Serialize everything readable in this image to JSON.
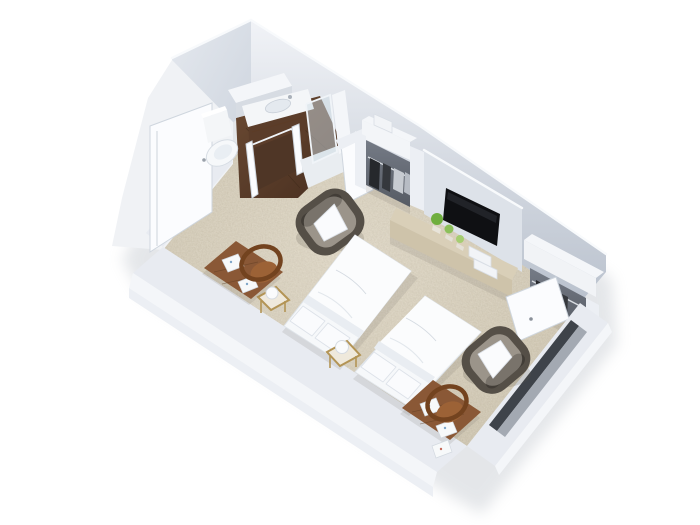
{
  "scene": {
    "type": "3d-floorplan-render",
    "description": "Isometric cutaway 3D rendering of a twin hotel guest room with en-suite bathroom",
    "background": "#ffffff",
    "rooms": [
      "bathroom",
      "entry-hall",
      "bedroom"
    ],
    "no_visible_text": true
  },
  "objects": [
    {
      "id": "toilet",
      "label": "toilet"
    },
    {
      "id": "vanity",
      "label": "vanity with sink"
    },
    {
      "id": "shower",
      "label": "glass shower"
    },
    {
      "id": "entry-door",
      "label": "open entry door"
    },
    {
      "id": "wardrobe-1",
      "label": "open wardrobe with hanging clothes"
    },
    {
      "id": "tv",
      "label": "wall-mounted flat screen tv"
    },
    {
      "id": "media-console",
      "label": "long media console with plants"
    },
    {
      "id": "plants",
      "label": "three small green plants"
    },
    {
      "id": "wardrobe-2",
      "label": "corner wardrobe with open door"
    },
    {
      "id": "bed-1",
      "label": "twin bed with white bedding"
    },
    {
      "id": "bed-2",
      "label": "twin bed with white bedding"
    },
    {
      "id": "nightstand-1",
      "label": "brass stand with sphere lamp"
    },
    {
      "id": "nightstand-2",
      "label": "brass stand with sphere lamp"
    },
    {
      "id": "desk-1",
      "label": "wooden desk with papers"
    },
    {
      "id": "desk-2",
      "label": "wooden desk with papers"
    },
    {
      "id": "chair-1",
      "label": "round-back wooden chair"
    },
    {
      "id": "chair-2",
      "label": "round-back wooden chair"
    },
    {
      "id": "armchair-1",
      "label": "taupe armchair with white cushion"
    },
    {
      "id": "armchair-2",
      "label": "taupe armchair with white cushion"
    },
    {
      "id": "window",
      "label": "dark window band in front wall"
    }
  ],
  "palette": {
    "carpet": "#d6cdb9",
    "carpet_light": "#e0d8c6",
    "carpet_dark": "#c7bda6",
    "wall_top": "#f1f3f7",
    "wall_light": "#e4e8ee",
    "wall_mid": "#ccd3dd",
    "wall_dark": "#b9c1cd",
    "wall_outer": "#f0f2f5",
    "wall_face": "#e8ebf1",
    "wood_light": "#6b4a33",
    "wood_dark": "#472e1f",
    "desk_wood": "#8a5836",
    "chair_wood": "#73431f",
    "chair_seat": "#9c6236",
    "bed_white": "#f6f8fa",
    "tv_black": "#0f1013",
    "console_tan": "#d9cfb8",
    "console_front": "#cec3aa",
    "plant_green": "#6fae3e",
    "plant_green2": "#8cc05a",
    "plant_green3": "#a5cd71",
    "armchair_frame": "#554f47",
    "armchair_seat": "#9b948a",
    "pillow_white": "#eff1f3",
    "window_dark": "#3e434a",
    "window_sill": "#a3a9b2",
    "brass": "#b39455",
    "closet_recess": "#757b86",
    "cloth_dark": "#26282c",
    "cloth_mid": "#35383d",
    "cloth_light": "#c7cbd1",
    "porcelain": "#f4f6f8",
    "glass": "#cddbe4"
  }
}
